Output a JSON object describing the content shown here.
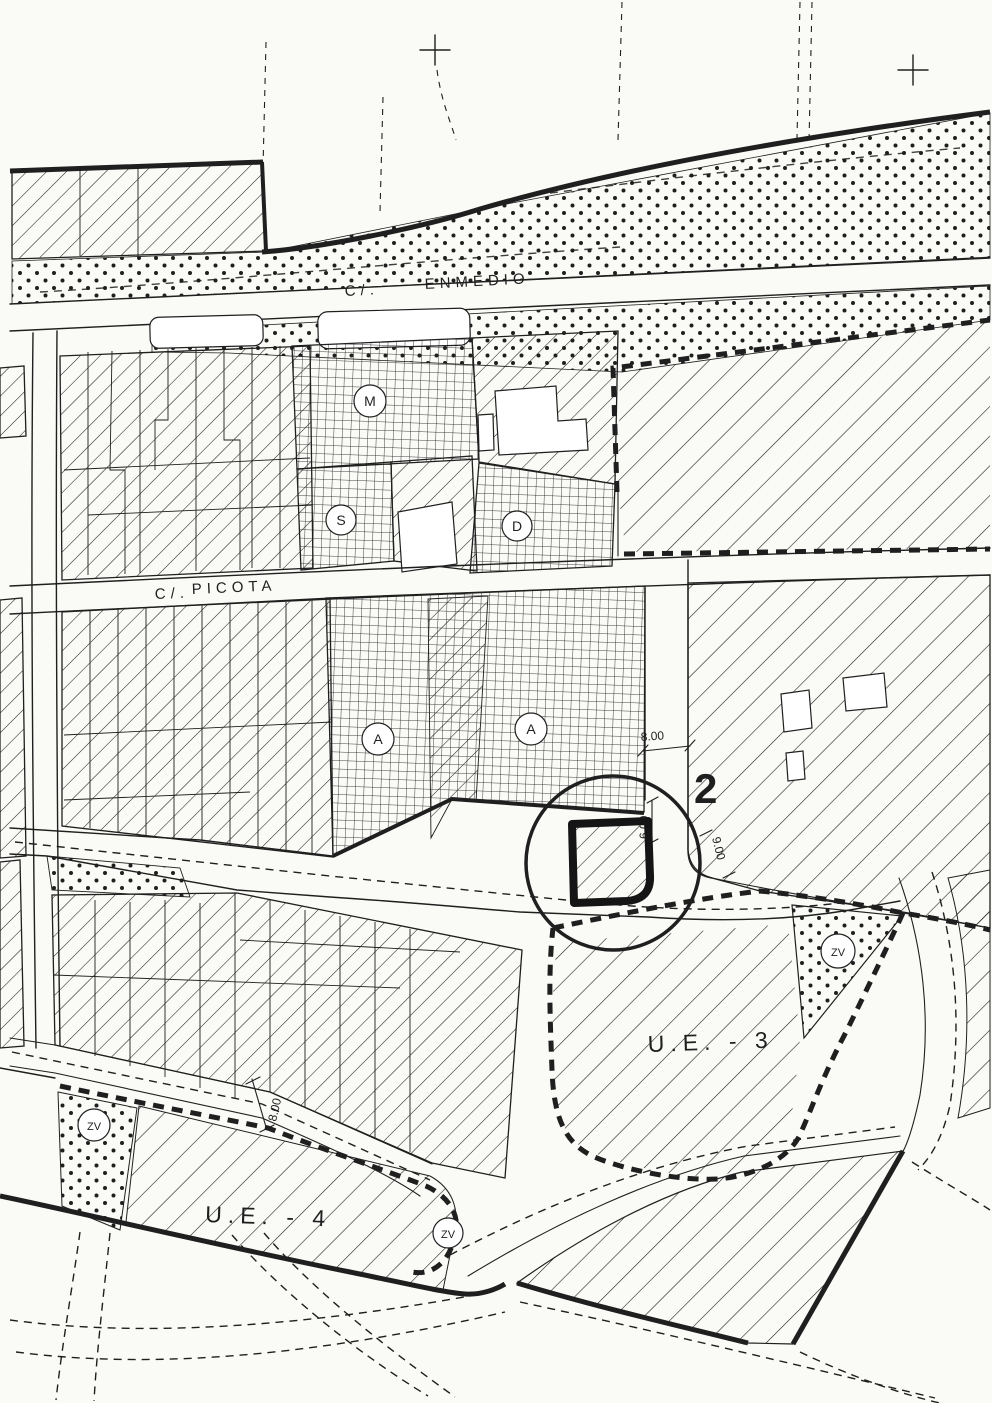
{
  "map": {
    "streets": {
      "enmedio": {
        "prefix": "C/.",
        "name": "ENMEDIO"
      },
      "picota": {
        "prefix": "C/.",
        "name": "PICOTA"
      }
    },
    "block_markers": {
      "m": "M",
      "s": "S",
      "d": "D",
      "a_west": "A",
      "a_east": "A"
    },
    "green_zones": {
      "ue3": "ZV",
      "ue4_west": "ZV",
      "ue4_east": "ZV"
    },
    "execution_units": {
      "ue3": "U.E. - 3",
      "ue4": "U.E. - 4"
    },
    "highlight": {
      "parcel_number": "2"
    },
    "dimensions": {
      "street_width": "8.00",
      "frontage_depth": "6.00",
      "road_width_east": "9.00",
      "road_width_southwest": "8.00"
    },
    "colors": {
      "ink": "#1f1f1f",
      "paper": "#fafaf7"
    }
  }
}
